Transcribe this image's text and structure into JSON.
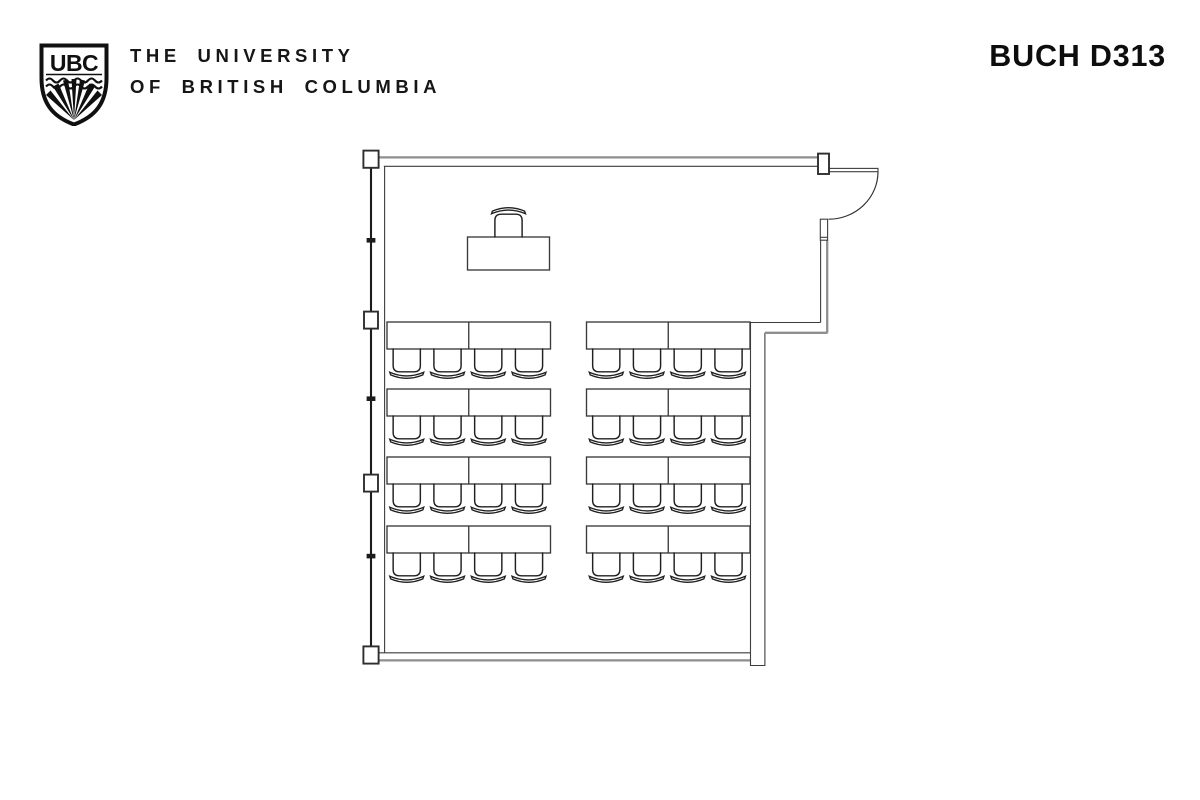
{
  "page": {
    "background": "#ffffff"
  },
  "header": {
    "logo": {
      "monogram": "UBC"
    },
    "wordmark_line1": "THE UNIVERSITY",
    "wordmark_line2": "OF BRITISH COLUMBIA",
    "room_label": "BUCH D313"
  },
  "floor_plan": {
    "colors": {
      "wall_band": "#8e8e8e",
      "wall_line": "#3d3d3d",
      "detail": "#1c1c1c",
      "table_stroke": "#3a3a3a",
      "chair_stroke": "#202020"
    },
    "student_seating": {
      "groups": 2,
      "rows_per_group": 4,
      "tables_per_row": 2,
      "chairs_per_row": 4,
      "total_tables": 16,
      "total_chairs": 32
    },
    "instructor_station": {
      "tables": 1,
      "chairs": 1
    },
    "door": {
      "location": "top-right",
      "type": "swing-arc"
    },
    "window_wall": {
      "side": "left",
      "posts": 4,
      "mullions": 3
    }
  }
}
